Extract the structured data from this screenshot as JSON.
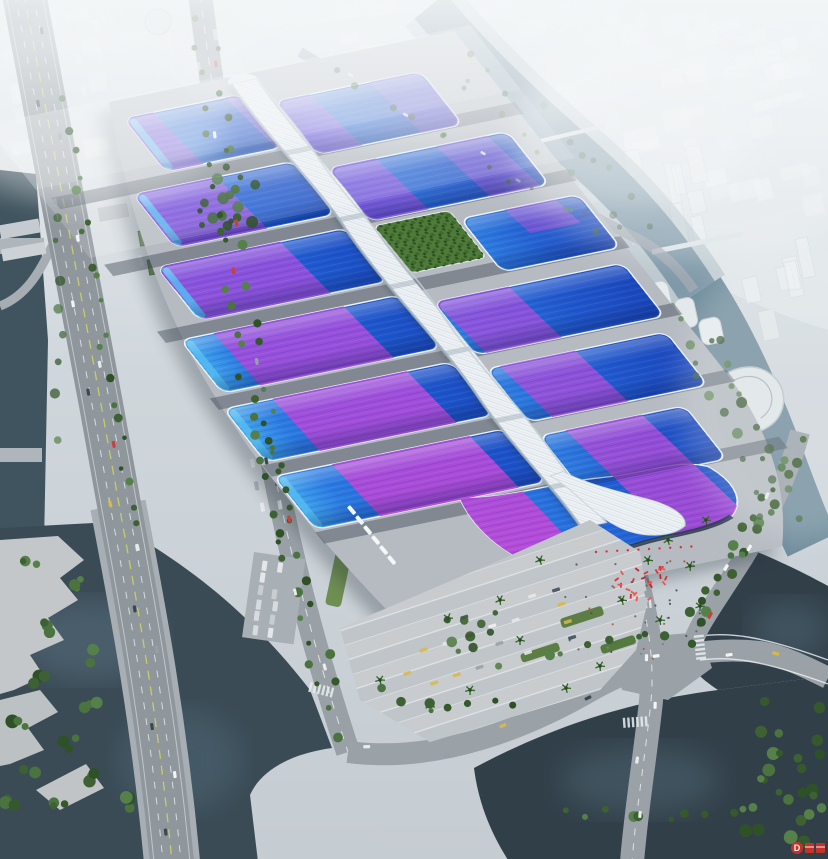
{
  "scene": {
    "type": "aerial architectural rendering",
    "subject": "Riverside exhibition and convention center: rows of blue wave-form hall roofs with purple ribbon stripes flanking a white serpentine central concourse, hazy city skyline behind, canals, highways, parking lots and a south entrance plaza with red installations",
    "landmarks": [
      "central-spine-corridor",
      "exhibition-hall-roofs",
      "green-roof-garden",
      "south-entrance-shell",
      "entrance-plaza",
      "west-expressway",
      "west-canal",
      "south-river",
      "northeast-river",
      "southeast-pond",
      "hazy-city-skyline"
    ]
  },
  "watermark": {
    "logo_letter": "D"
  },
  "palette": {
    "hall_blue": "#2b72dd",
    "hall_deep_blue": "#1b4ec4",
    "hall_cyan": "#3fa9ec",
    "ribbon_purple": "#7a55d8",
    "ribbon_magenta": "#b648d4",
    "spine_white": "#edf1f4",
    "ground_grey": "#c9d1d7",
    "road_grey": "#8f979d",
    "water_dark": "#3b4c57",
    "water_teal": "#7d97a6",
    "vegetation_green": "#4d7a36",
    "red_accent": "#d43028",
    "haze_white": "#eef2f4"
  }
}
